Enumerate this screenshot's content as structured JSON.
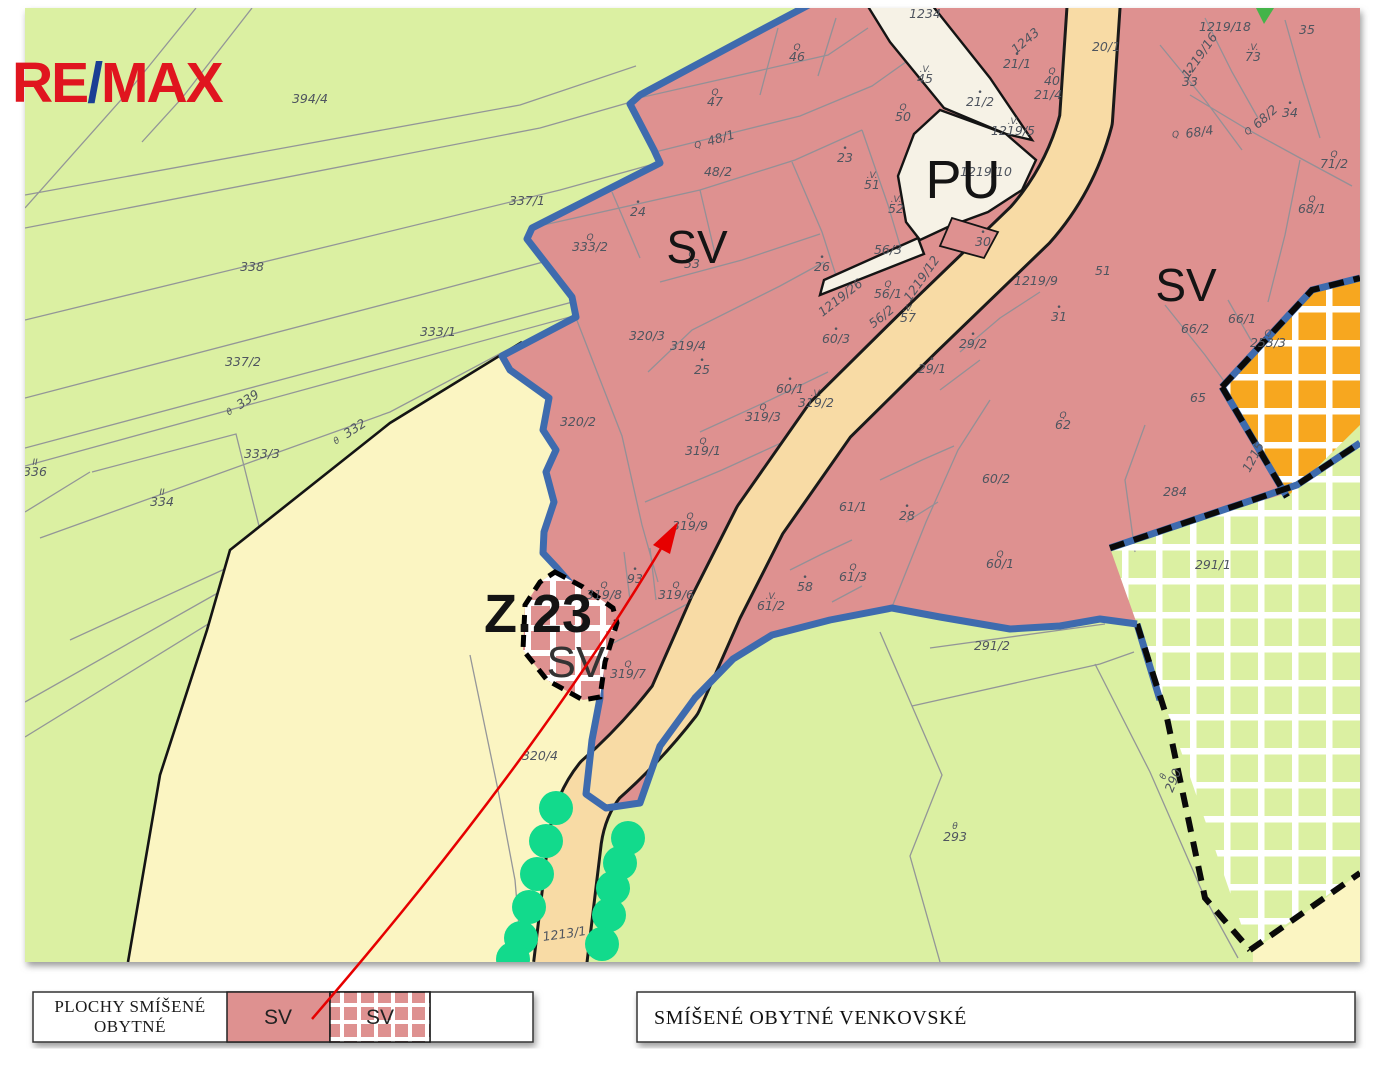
{
  "branding": {
    "re": "RE",
    "slash": "/",
    "max": "MAX"
  },
  "map": {
    "zone_labels": [
      {
        "t": "SV",
        "x": 697,
        "y": 263,
        "s": 46
      },
      {
        "t": "PU",
        "x": 963,
        "y": 198,
        "s": 54
      },
      {
        "t": "SV",
        "x": 1186,
        "y": 301,
        "s": 46
      },
      {
        "t": "Z.23",
        "x": 538,
        "y": 632,
        "s": 54,
        "b": 1
      },
      {
        "t": "SV",
        "x": 576,
        "y": 677,
        "s": 44,
        "f": "#333333"
      }
    ],
    "parcel_labels": [
      {
        "t": "394/4",
        "x": 310,
        "y": 103
      },
      {
        "t": "338",
        "x": 252,
        "y": 271
      },
      {
        "t": "337/1",
        "x": 527,
        "y": 205
      },
      {
        "t": "333/1",
        "x": 438,
        "y": 336
      },
      {
        "t": "337/2",
        "x": 243,
        "y": 366
      },
      {
        "t": "339",
        "x": 250,
        "y": 403,
        "r": -33,
        "sym": "θ",
        "sx": -22,
        "sy": -1
      },
      {
        "t": "332",
        "x": 357,
        "y": 432,
        "r": -33,
        "sym": "θ",
        "sx": -22,
        "sy": -1
      },
      {
        "t": "333/3",
        "x": 262,
        "y": 458
      },
      {
        "t": "336",
        "x": 35,
        "y": 476,
        "sym": "II"
      },
      {
        "t": "334",
        "x": 162,
        "y": 506,
        "sym": "II"
      },
      {
        "t": "7",
        "x": 20,
        "y": 684
      },
      {
        "t": "46",
        "x": 797,
        "y": 61,
        "sym": "Q"
      },
      {
        "t": "47",
        "x": 715,
        "y": 106,
        "sym": "Q"
      },
      {
        "t": "48/1",
        "x": 722,
        "y": 142,
        "r": -16,
        "sym": "Q",
        "sx": -24,
        "sy": -1
      },
      {
        "t": "48/2",
        "x": 718,
        "y": 176
      },
      {
        "t": "24",
        "x": 638,
        "y": 216,
        "sym": "•"
      },
      {
        "t": "333/2",
        "x": 590,
        "y": 251,
        "sym": "Q"
      },
      {
        "t": "53",
        "x": 692,
        "y": 268,
        "sym": "Q"
      },
      {
        "t": "26",
        "x": 822,
        "y": 271,
        "sym": "•"
      },
      {
        "t": "23",
        "x": 845,
        "y": 162,
        "sym": "•"
      },
      {
        "t": "50",
        "x": 903,
        "y": 121,
        "sym": "Q"
      },
      {
        "t": "45",
        "x": 925,
        "y": 83,
        "sym": ".V."
      },
      {
        "t": "1234",
        "x": 925,
        "y": 18
      },
      {
        "t": "51",
        "x": 872,
        "y": 189,
        "sym": ".V."
      },
      {
        "t": "52",
        "x": 896,
        "y": 213,
        "sym": ".V."
      },
      {
        "t": "56/3",
        "x": 888,
        "y": 254
      },
      {
        "t": "1219/26",
        "x": 843,
        "y": 301,
        "r": -38
      },
      {
        "t": "56/1",
        "x": 888,
        "y": 298,
        "sym": "Q"
      },
      {
        "t": "56/2",
        "x": 884,
        "y": 320,
        "r": -38
      },
      {
        "t": "57",
        "x": 908,
        "y": 322,
        "sym": ".V."
      },
      {
        "t": "1219/12",
        "x": 925,
        "y": 281,
        "r": -55
      },
      {
        "t": "60/3",
        "x": 836,
        "y": 343,
        "sym": "•"
      },
      {
        "t": "319/2",
        "x": 816,
        "y": 407,
        "sym": ".V."
      },
      {
        "t": "60/1",
        "x": 790,
        "y": 393,
        "sym": "•"
      },
      {
        "t": "319/4",
        "x": 688,
        "y": 350
      },
      {
        "t": "25",
        "x": 702,
        "y": 374,
        "sym": "•"
      },
      {
        "t": "319/3",
        "x": 763,
        "y": 421,
        "sym": "Q"
      },
      {
        "t": "320/3",
        "x": 647,
        "y": 340
      },
      {
        "t": "319/1",
        "x": 703,
        "y": 455,
        "sym": "Q"
      },
      {
        "t": "320/2",
        "x": 578,
        "y": 426
      },
      {
        "t": "319/9",
        "x": 690,
        "y": 530,
        "sym": "Q"
      },
      {
        "t": "93",
        "x": 635,
        "y": 583,
        "sym": "•"
      },
      {
        "t": "319/8",
        "x": 604,
        "y": 599,
        "sym": "Q"
      },
      {
        "t": "319/6",
        "x": 676,
        "y": 599,
        "sym": "Q"
      },
      {
        "t": "319/7",
        "x": 628,
        "y": 678,
        "sym": "Q"
      },
      {
        "t": "61/2",
        "x": 771,
        "y": 610,
        "sym": ".V."
      },
      {
        "t": "58",
        "x": 805,
        "y": 591,
        "sym": "•"
      },
      {
        "t": "61/3",
        "x": 853,
        "y": 581,
        "sym": "Q"
      },
      {
        "t": "61/1",
        "x": 853,
        "y": 511
      },
      {
        "t": "28",
        "x": 907,
        "y": 520,
        "sym": "•"
      },
      {
        "t": "1219/9",
        "x": 1036,
        "y": 285
      },
      {
        "t": "31",
        "x": 1059,
        "y": 321,
        "sym": "•"
      },
      {
        "t": "51",
        "x": 1103,
        "y": 275
      },
      {
        "t": "29/2",
        "x": 973,
        "y": 348,
        "sym": "•"
      },
      {
        "t": "29/1",
        "x": 932,
        "y": 373,
        "sym": "•"
      },
      {
        "t": "62",
        "x": 1063,
        "y": 429,
        "sym": "Q"
      },
      {
        "t": "60/2",
        "x": 996,
        "y": 483
      },
      {
        "t": "60/1",
        "x": 1000,
        "y": 568,
        "sym": "Q"
      },
      {
        "t": "66/1",
        "x": 1242,
        "y": 323
      },
      {
        "t": "66/2",
        "x": 1195,
        "y": 333
      },
      {
        "t": "253/3",
        "x": 1268,
        "y": 347,
        "sym": "Q"
      },
      {
        "t": "65",
        "x": 1198,
        "y": 402
      },
      {
        "t": "284",
        "x": 1175,
        "y": 496
      },
      {
        "t": "1215",
        "x": 1257,
        "y": 459,
        "r": -62
      },
      {
        "t": "291/1",
        "x": 1213,
        "y": 569
      },
      {
        "t": "291/2",
        "x": 992,
        "y": 650
      },
      {
        "t": "293",
        "x": 955,
        "y": 841,
        "sym": "θ",
        "sy": -12
      },
      {
        "t": "290",
        "x": 1177,
        "y": 782,
        "r": -68,
        "sym": "θ",
        "sy": -12
      },
      {
        "t": "320/4",
        "x": 540,
        "y": 760
      },
      {
        "t": "1213/1",
        "x": 565,
        "y": 938,
        "r": -8
      },
      {
        "t": "20/1",
        "x": 1106,
        "y": 51
      },
      {
        "t": "21/1",
        "x": 1017,
        "y": 68,
        "sym": "•"
      },
      {
        "t": "40",
        "x": 1052,
        "y": 85,
        "sym": "Q"
      },
      {
        "t": "21/4",
        "x": 1048,
        "y": 99
      },
      {
        "t": "21/2",
        "x": 980,
        "y": 106,
        "sym": "•"
      },
      {
        "t": "1219/5",
        "x": 1013,
        "y": 135,
        "sym": ".V."
      },
      {
        "t": "1243",
        "x": 1028,
        "y": 44,
        "r": -40
      },
      {
        "t": "1219/10",
        "x": 986,
        "y": 176
      },
      {
        "t": "30",
        "x": 983,
        "y": 246,
        "sym": "•"
      },
      {
        "t": "1219/18",
        "x": 1225,
        "y": 31
      },
      {
        "t": "73",
        "x": 1253,
        "y": 61,
        "sym": ".V."
      },
      {
        "t": "1219/16",
        "x": 1203,
        "y": 58,
        "r": -55
      },
      {
        "t": "33",
        "x": 1190,
        "y": 86,
        "sym": "•"
      },
      {
        "t": "35",
        "x": 1307,
        "y": 34
      },
      {
        "t": "68/2",
        "x": 1268,
        "y": 120,
        "r": -42,
        "sym": "Q",
        "sx": -22,
        "sy": -2
      },
      {
        "t": "34",
        "x": 1290,
        "y": 117,
        "sym": "•"
      },
      {
        "t": "68/4",
        "x": 1200,
        "y": 136,
        "r": -8,
        "sym": "Q",
        "sx": -24,
        "sy": -2
      },
      {
        "t": "71/2",
        "x": 1334,
        "y": 168,
        "sym": "Q"
      },
      {
        "t": "68/1",
        "x": 1312,
        "y": 213,
        "sym": "Q"
      },
      {
        "t": "71",
        "x": 1370,
        "y": 228
      }
    ]
  },
  "legend": {
    "left": {
      "title_line1": "PLOCHY SMÍŠENÉ",
      "title_line2": "OBYTNÉ",
      "swatch1_label": "SV",
      "swatch2_label": "SV"
    },
    "right": {
      "label": "SMÍŠENÉ OBYTNÉ VENKOVSKÉ"
    }
  },
  "colors": {
    "sv_pink": "#de9190",
    "pu_cream": "#f6f2e6",
    "road_tan": "#f8dba5",
    "field_green": "#dbf0a2",
    "farm_yellow": "#fbf5c2",
    "reserve_orange": "#f7a71f",
    "boundary_blue": "#3e6bae",
    "tree_green": "#12da8c",
    "arrow_red": "#e60000",
    "remax_red": "#e0151f",
    "remax_blue": "#1b3f94"
  }
}
